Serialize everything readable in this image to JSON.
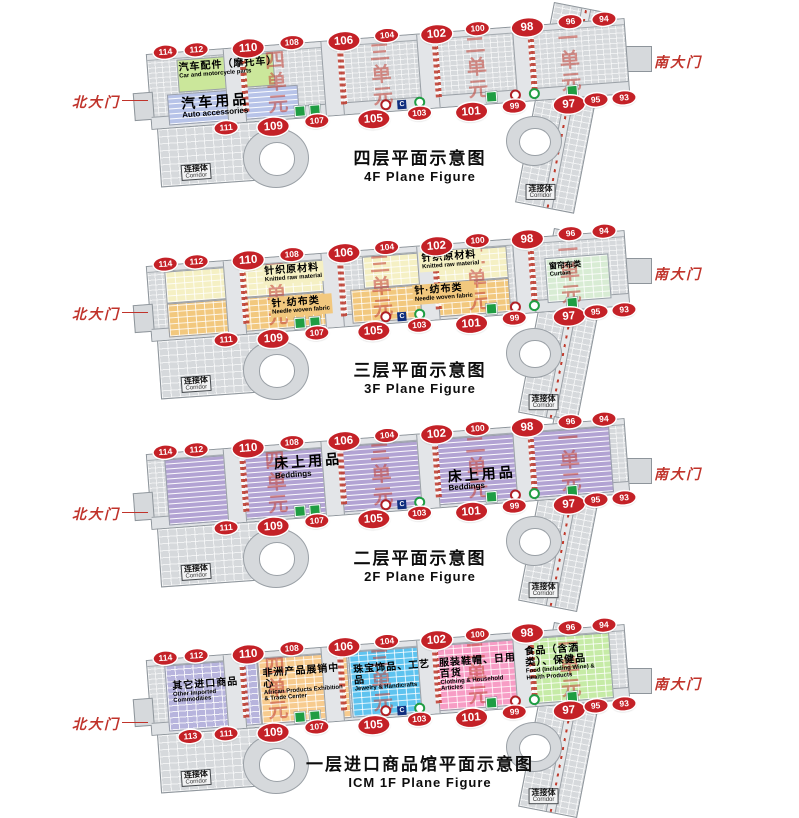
{
  "shared": {
    "north_gate": "北大门",
    "south_gate": "南大门",
    "corridor_cn": "连接体",
    "corridor_en": "Corridor",
    "units": [
      "四单元",
      "三单元",
      "二单元",
      "一单元"
    ],
    "unit_pcts": [
      24,
      46,
      66,
      85.5
    ],
    "colors": {
      "gate_red": "#c42127",
      "unit_red": "#c1493e",
      "entrance_label_red": "#c0332b",
      "building_gray": "#d6d9dc"
    },
    "service_icons": [
      {
        "name": "toilet-icon",
        "style": "green-box",
        "pct": 30,
        "glyph": ""
      },
      {
        "name": "toilet-icon",
        "style": "green-box",
        "pct": 33,
        "glyph": ""
      },
      {
        "name": "bank-icon",
        "style": "red-ring",
        "pct": 48,
        "glyph": ""
      },
      {
        "name": "c-logo-icon",
        "style": "navy-box",
        "pct": 51.5,
        "glyph": "C"
      },
      {
        "name": "eco-icon",
        "style": "green-ring",
        "pct": 55,
        "glyph": ""
      },
      {
        "name": "toilet-icon",
        "style": "green-box",
        "pct": 70,
        "glyph": ""
      },
      {
        "name": "bank-icon",
        "style": "red-ring",
        "pct": 75,
        "glyph": ""
      },
      {
        "name": "eco-icon",
        "style": "green-ring",
        "pct": 79,
        "glyph": ""
      },
      {
        "name": "toilet-icon",
        "style": "green-box",
        "pct": 87,
        "glyph": ""
      }
    ]
  },
  "floors": [
    {
      "id": "4f",
      "caption_cn": "四层平面示意图",
      "caption_en": "4F Plane Figure",
      "top_gates": [
        {
          "n": "114",
          "pct": 1.5
        },
        {
          "n": "112",
          "pct": 8
        },
        {
          "n": "110",
          "pct": 18,
          "big": true
        },
        {
          "n": "108",
          "pct": 28
        },
        {
          "n": "106",
          "pct": 38,
          "big": true
        },
        {
          "n": "104",
          "pct": 48
        },
        {
          "n": "102",
          "pct": 57.5,
          "big": true
        },
        {
          "n": "100",
          "pct": 67
        },
        {
          "n": "98",
          "pct": 76.5,
          "big": true
        },
        {
          "n": "96",
          "pct": 86.5
        },
        {
          "n": "94",
          "pct": 93.5
        }
      ],
      "bottom_gates": [
        {
          "n": "111",
          "pct": 13
        },
        {
          "n": "109",
          "pct": 22,
          "big": true
        },
        {
          "n": "107",
          "pct": 32
        },
        {
          "n": "105",
          "pct": 43,
          "big": true
        },
        {
          "n": "103",
          "pct": 53.5
        },
        {
          "n": "101",
          "pct": 63.5,
          "big": true
        },
        {
          "n": "99",
          "pct": 73.5
        },
        {
          "n": "97",
          "pct": 84,
          "big": true
        },
        {
          "n": "95",
          "pct": 90.5
        },
        {
          "n": "93",
          "pct": 96.5
        }
      ],
      "zones": [
        {
          "color": "#cbe79b",
          "pattern": "solid",
          "left": 6,
          "top": 10,
          "width": 20,
          "height": 42
        },
        {
          "color": "#b7c3e8",
          "pattern": "rows",
          "left": 3.5,
          "top": 55,
          "width": 27,
          "height": 40
        }
      ],
      "labels": [
        {
          "cn": "汽车配件（摩托车）",
          "en": "Car and motorcycle parts",
          "left": 6,
          "top": 12,
          "width": 20
        },
        {
          "cn": "汽车用品",
          "en": "Auto accessories",
          "left": 6,
          "top": 58,
          "width": 24,
          "big": true
        }
      ]
    },
    {
      "id": "3f",
      "caption_cn": "三层平面示意图",
      "caption_en": "3F Plane Figure",
      "top_gates": [
        {
          "n": "114",
          "pct": 1.5
        },
        {
          "n": "112",
          "pct": 8
        },
        {
          "n": "110",
          "pct": 18,
          "big": true
        },
        {
          "n": "108",
          "pct": 28
        },
        {
          "n": "106",
          "pct": 38,
          "big": true
        },
        {
          "n": "104",
          "pct": 48
        },
        {
          "n": "102",
          "pct": 57.5,
          "big": true
        },
        {
          "n": "100",
          "pct": 67
        },
        {
          "n": "98",
          "pct": 76.5,
          "big": true
        },
        {
          "n": "96",
          "pct": 86.5
        },
        {
          "n": "94",
          "pct": 93.5
        }
      ],
      "bottom_gates": [
        {
          "n": "111",
          "pct": 13
        },
        {
          "n": "109",
          "pct": 22,
          "big": true
        },
        {
          "n": "107",
          "pct": 32
        },
        {
          "n": "105",
          "pct": 43,
          "big": true
        },
        {
          "n": "103",
          "pct": 53.5
        },
        {
          "n": "101",
          "pct": 63.5,
          "big": true
        },
        {
          "n": "99",
          "pct": 73.5
        },
        {
          "n": "97",
          "pct": 84,
          "big": true
        },
        {
          "n": "95",
          "pct": 90.5
        },
        {
          "n": "93",
          "pct": 96.5
        }
      ],
      "zones": [
        {
          "color": "#f5f0c4",
          "pattern": "grid",
          "left": 3.5,
          "top": 8,
          "width": 34,
          "height": 40
        },
        {
          "color": "#f5f0c4",
          "pattern": "grid",
          "left": 45,
          "top": 8,
          "width": 30,
          "height": 40
        },
        {
          "color": "#f2c87e",
          "pattern": "grid",
          "left": 3.5,
          "top": 52,
          "width": 35,
          "height": 42
        },
        {
          "color": "#f2c87e",
          "pattern": "grid",
          "left": 42,
          "top": 52,
          "width": 33,
          "height": 42
        },
        {
          "color": "#d8ecd4",
          "pattern": "grid",
          "left": 83,
          "top": 28,
          "width": 13,
          "height": 58
        }
      ],
      "labels": [
        {
          "cn": "针织原材料",
          "en": "Knitted raw material",
          "left": 24,
          "top": 10,
          "bg": "#f5f0c4"
        },
        {
          "cn": "针·纺布类",
          "en": "Needle woven fabric",
          "left": 25,
          "top": 54,
          "bg": "#f2c87e"
        },
        {
          "cn": "针织原材料",
          "en": "Knitted raw material",
          "left": 57,
          "top": 8,
          "bg": "#f5f0c4"
        },
        {
          "cn": "针·纺布类",
          "en": "Needle woven fabric",
          "left": 55,
          "top": 52,
          "bg": "#f2c87e"
        },
        {
          "cn": "窗帘布类",
          "en": "Curtain",
          "left": 83.5,
          "top": 34,
          "small": true
        }
      ]
    },
    {
      "id": "2f",
      "caption_cn": "二层平面示意图",
      "caption_en": "2F Plane Figure",
      "top_gates": [
        {
          "n": "114",
          "pct": 1.5
        },
        {
          "n": "112",
          "pct": 8
        },
        {
          "n": "110",
          "pct": 18,
          "big": true
        },
        {
          "n": "108",
          "pct": 28
        },
        {
          "n": "106",
          "pct": 38,
          "big": true
        },
        {
          "n": "104",
          "pct": 48
        },
        {
          "n": "102",
          "pct": 57.5,
          "big": true
        },
        {
          "n": "100",
          "pct": 67
        },
        {
          "n": "98",
          "pct": 76.5,
          "big": true
        },
        {
          "n": "96",
          "pct": 86.5
        },
        {
          "n": "94",
          "pct": 93.5
        }
      ],
      "bottom_gates": [
        {
          "n": "111",
          "pct": 13
        },
        {
          "n": "109",
          "pct": 22,
          "big": true
        },
        {
          "n": "107",
          "pct": 32
        },
        {
          "n": "105",
          "pct": 43,
          "big": true
        },
        {
          "n": "103",
          "pct": 53.5
        },
        {
          "n": "101",
          "pct": 63.5,
          "big": true
        },
        {
          "n": "99",
          "pct": 73.5
        },
        {
          "n": "97",
          "pct": 84,
          "big": true
        },
        {
          "n": "95",
          "pct": 90.5
        },
        {
          "n": "93",
          "pct": 96.5
        }
      ],
      "zones": [
        {
          "color": "#b2a3d3",
          "pattern": "rows",
          "left": 3.5,
          "top": 8,
          "width": 93,
          "height": 86
        }
      ],
      "labels": [
        {
          "cn": "床上用品",
          "en": "Beddings",
          "left": 26,
          "top": 14,
          "big": true
        },
        {
          "cn": "床上用品",
          "en": "Beddings",
          "left": 62,
          "top": 48,
          "big": true
        }
      ]
    },
    {
      "id": "1f",
      "caption_cn": "一层进口商品馆平面示意图",
      "caption_en": "ICM  1F Plane Figure",
      "top_gates": [
        {
          "n": "114",
          "pct": 1.5
        },
        {
          "n": "112",
          "pct": 8
        },
        {
          "n": "110",
          "pct": 18,
          "big": true
        },
        {
          "n": "108",
          "pct": 28
        },
        {
          "n": "106",
          "pct": 38,
          "big": true
        },
        {
          "n": "104",
          "pct": 48
        },
        {
          "n": "102",
          "pct": 57.5,
          "big": true
        },
        {
          "n": "100",
          "pct": 67
        },
        {
          "n": "98",
          "pct": 76.5,
          "big": true
        },
        {
          "n": "96",
          "pct": 86.5
        },
        {
          "n": "94",
          "pct": 93.5
        }
      ],
      "bottom_gates": [
        {
          "n": "113",
          "pct": 5.5
        },
        {
          "n": "111",
          "pct": 13
        },
        {
          "n": "109",
          "pct": 22,
          "big": true
        },
        {
          "n": "107",
          "pct": 32
        },
        {
          "n": "105",
          "pct": 43,
          "big": true
        },
        {
          "n": "103",
          "pct": 53.5
        },
        {
          "n": "101",
          "pct": 63.5,
          "big": true
        },
        {
          "n": "99",
          "pct": 73.5
        },
        {
          "n": "97",
          "pct": 84,
          "big": true
        },
        {
          "n": "95",
          "pct": 90.5
        },
        {
          "n": "93",
          "pct": 96.5
        }
      ],
      "zones": [
        {
          "color": "#b7b4dd",
          "pattern": "grid",
          "left": 3.5,
          "top": 8,
          "width": 19,
          "height": 86
        },
        {
          "color": "#f7cb8e",
          "pattern": "grid",
          "left": 23,
          "top": 8,
          "width": 18.5,
          "height": 86
        },
        {
          "color": "#5ec3ef",
          "pattern": "grid",
          "left": 42,
          "top": 8,
          "width": 17.5,
          "height": 86
        },
        {
          "color": "#f79dc5",
          "pattern": "grid",
          "left": 60,
          "top": 8,
          "width": 17.5,
          "height": 86
        },
        {
          "color": "#c6eba6",
          "pattern": "grid",
          "left": 78,
          "top": 8,
          "width": 18.5,
          "height": 86
        }
      ],
      "labels": [
        {
          "cn": "其它进口商品",
          "en": "Other Imported Commodities",
          "left": 4.5,
          "top": 28,
          "width": 17
        },
        {
          "cn": "非洲产品展销中心",
          "en": "African Products Exhibition & Trade Center",
          "left": 23.5,
          "top": 20,
          "width": 17.5
        },
        {
          "cn": "珠宝饰品、工艺品",
          "en": "Jewelry & Handicrafts",
          "left": 42.5,
          "top": 24,
          "width": 17
        },
        {
          "cn": "服装鞋帽、日用百货",
          "en": "Clothing & Household Articles",
          "left": 60.5,
          "top": 24,
          "width": 17
        },
        {
          "cn": "食品（含酒类）、保健品",
          "en": "Food (Including Wine) & Health Products",
          "left": 78.5,
          "top": 18,
          "width": 17
        }
      ]
    }
  ]
}
